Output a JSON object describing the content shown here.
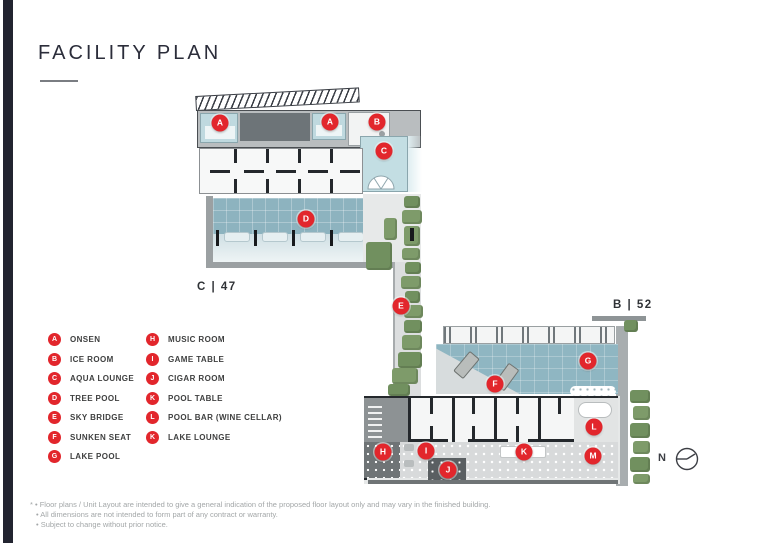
{
  "page": {
    "title": "FACILITY PLAN",
    "footnotes": [
      "* • Floor plans / Unit Layout are intended to give a general indication of the proposed floor layout only and may vary in the finished building.",
      "• All dimensions are not intended to form part of any contract or warranty.",
      "• Subject to change without prior notice."
    ]
  },
  "plan": {
    "zone_label_left": "C | 47",
    "zone_label_right": "B | 52",
    "compass_label": "N"
  },
  "legend": {
    "columns": [
      {
        "items": [
          {
            "letter": "A",
            "label": "ONSEN"
          },
          {
            "letter": "B",
            "label": "ICE ROOM"
          },
          {
            "letter": "C",
            "label": "AQUA LOUNGE"
          },
          {
            "letter": "D",
            "label": "TREE POOL"
          },
          {
            "letter": "E",
            "label": "SKY BRIDGE"
          },
          {
            "letter": "F",
            "label": "SUNKEN SEAT"
          },
          {
            "letter": "G",
            "label": "LAKE POOL"
          }
        ]
      },
      {
        "items": [
          {
            "letter": "H",
            "label": "MUSIC ROOM"
          },
          {
            "letter": "I",
            "label": "GAME TABLE"
          },
          {
            "letter": "J",
            "label": "CIGAR ROOM"
          },
          {
            "letter": "K",
            "label": "POOL TABLE"
          },
          {
            "letter": "L",
            "label": "POOL BAR (WINE CELLAR)"
          },
          {
            "letter": "K",
            "label": "LAKE LOUNGE"
          }
        ]
      }
    ]
  },
  "markers": [
    {
      "letter": "A"
    },
    {
      "letter": "A"
    },
    {
      "letter": "B"
    },
    {
      "letter": "C"
    },
    {
      "letter": "D"
    },
    {
      "letter": "E"
    },
    {
      "letter": "F"
    },
    {
      "letter": "G"
    },
    {
      "letter": "H"
    },
    {
      "letter": "I"
    },
    {
      "letter": "J"
    },
    {
      "letter": "K"
    },
    {
      "letter": "L"
    },
    {
      "letter": "M"
    }
  ],
  "colors": {
    "marker_red": "#e2262c",
    "pool_teal": "#8db3bf",
    "tree_green": "#7e9b6a",
    "accent_dark": "#222430"
  }
}
